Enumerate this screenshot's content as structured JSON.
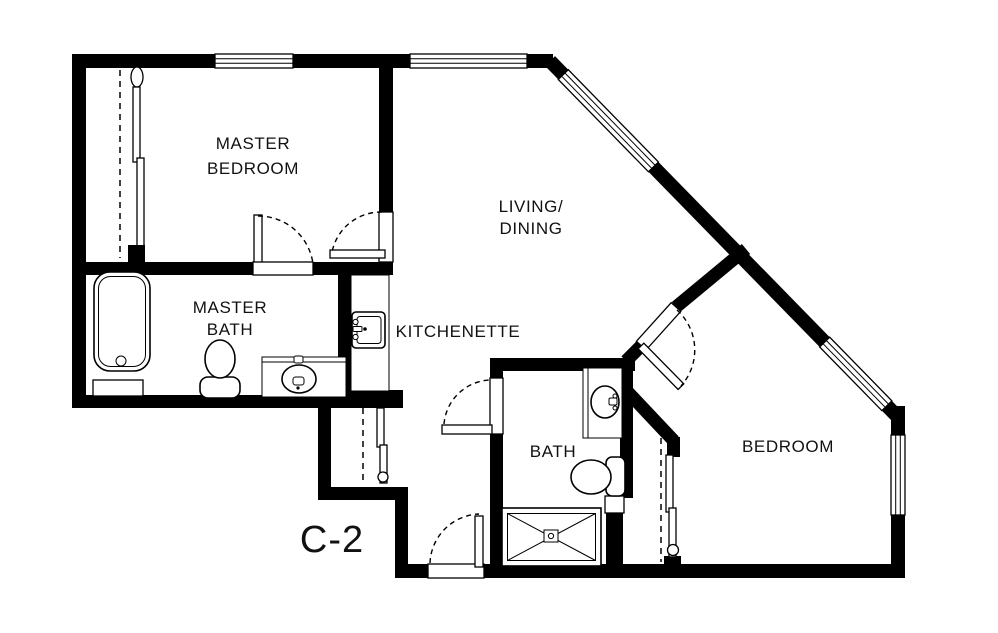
{
  "floor_plan": {
    "unit_label": "C-2",
    "labels": {
      "master_bedroom_1": "MASTER",
      "master_bedroom_2": "BEDROOM",
      "master_bath_1": "MASTER",
      "master_bath_2": "BATH",
      "living_dining_1": "LIVING/",
      "living_dining_2": "DINING",
      "kitchenette": "KITCHENETTE",
      "bath": "BATH",
      "bedroom": "BEDROOM"
    },
    "colors": {
      "walls": "#000000",
      "background": "#ffffff",
      "text": "#111111"
    }
  }
}
